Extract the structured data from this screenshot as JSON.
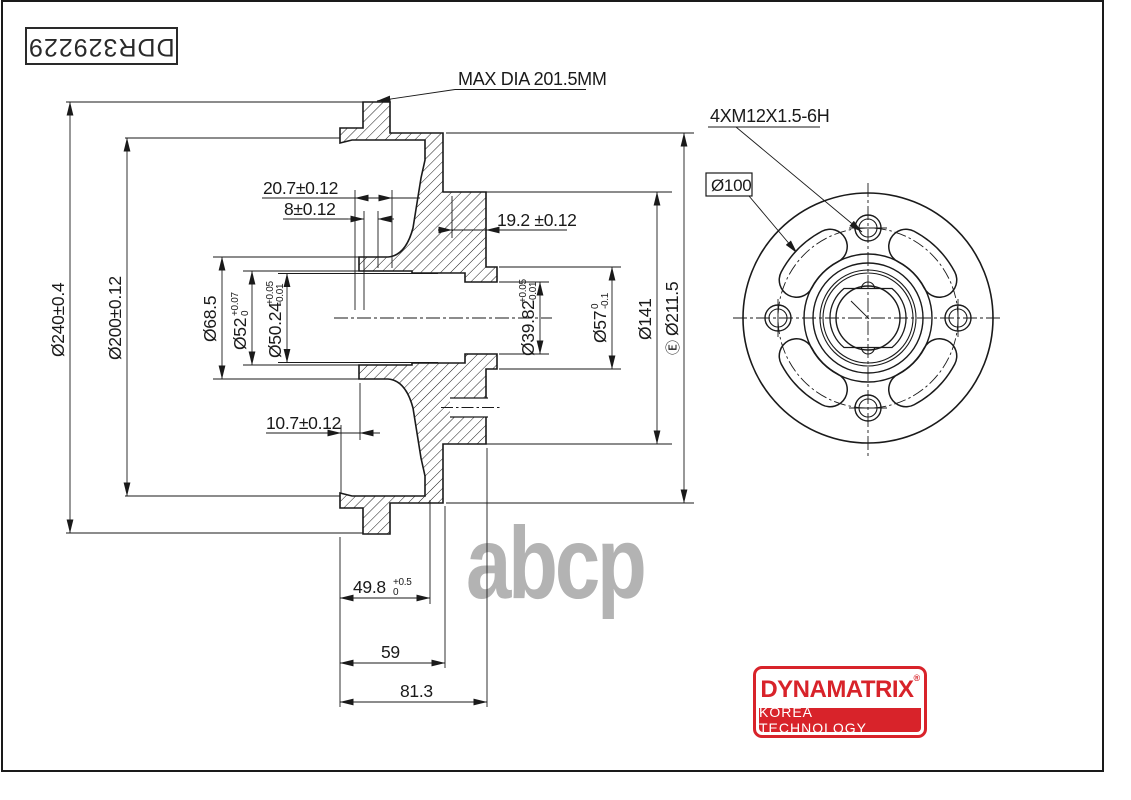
{
  "frame": {
    "part_number": "DDR329229"
  },
  "watermark": {
    "text": "abcp",
    "color": "#b3b3b3"
  },
  "logo": {
    "brand": "DYNAMATRIX",
    "reg": "®",
    "tagline": "KOREA TECHNOLOGY",
    "red": "#d8232a"
  },
  "callouts": {
    "max_dia": "MAX DIA 201.5MM",
    "thread": "4XM12X1.5-6H",
    "bolt_circle": "Ø100"
  },
  "dims": {
    "d240": "Ø240±0.4",
    "d200": "Ø200±0.12",
    "d68_5": "Ø68.5",
    "d52": {
      "main": "Ø52",
      "up": "+0.07",
      "dn": "0"
    },
    "d50_24": {
      "main": "Ø50.24",
      "up": "+0.05",
      "dn": "-0.01"
    },
    "d39_82": {
      "main": "Ø39.82",
      "up": "+0.05",
      "dn": "-0.01"
    },
    "d57": {
      "main": "Ø57",
      "up": "0",
      "dn": "-0.1"
    },
    "d141": "Ø141",
    "d211_5": {
      "env": "Ⓔ",
      "main": "Ø211.5"
    },
    "l20_7": "20.7±0.12",
    "l8": "8±0.12",
    "l19_2": "19.2 ±0.12",
    "l10_7": "10.7±0.12",
    "l49_8": {
      "main": "49.8",
      "up": "+0.5",
      "dn": "0"
    },
    "l59": "59",
    "l81_3": "81.3"
  }
}
